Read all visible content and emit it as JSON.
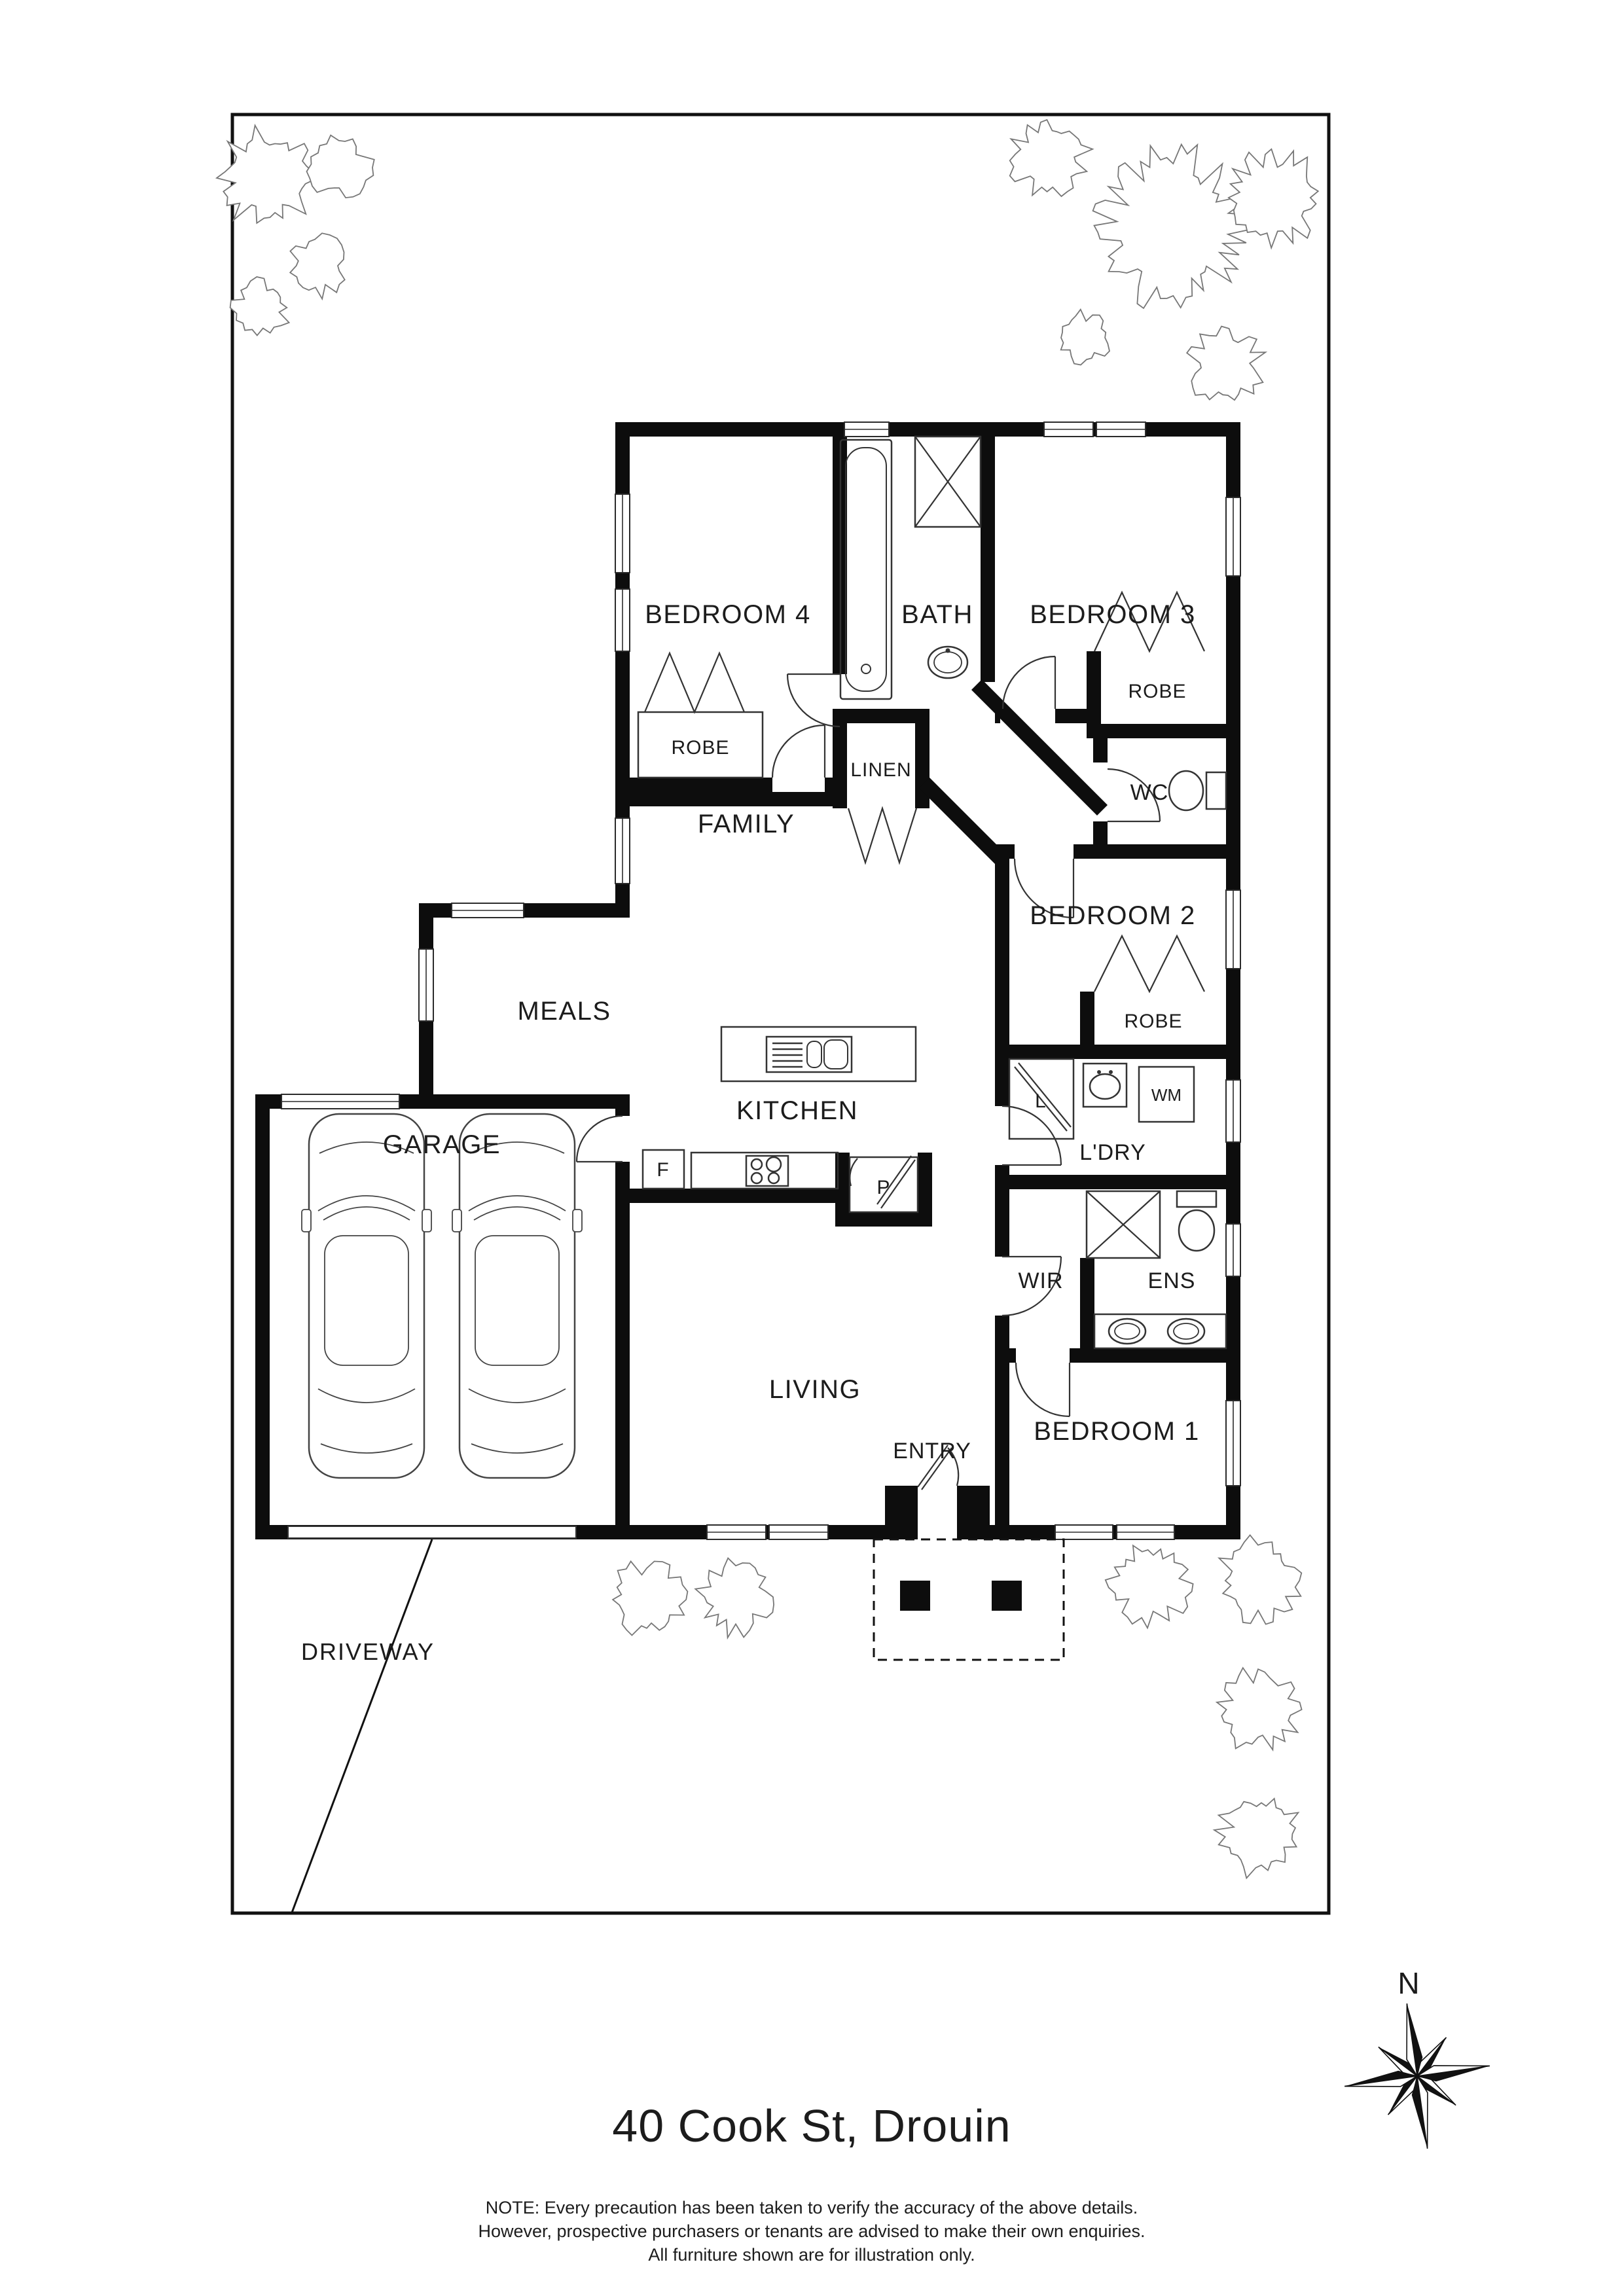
{
  "header": {
    "title": "40 Cook St, Drouin"
  },
  "footer": {
    "note_lines": [
      "NOTE: Every precaution has been taken to verify the accuracy of the above details.",
      "However, prospective purchasers or tenants are advised to make their own enquiries.",
      "All furniture shown are for illustration only."
    ]
  },
  "compass": {
    "north": "N"
  },
  "site": {
    "driveway": "DRIVEWAY"
  },
  "rooms": {
    "bedroom1": "BEDROOM 1",
    "bedroom2": "BEDROOM 2",
    "bedroom3": "BEDROOM 3",
    "bedroom4": "BEDROOM 4",
    "bath": "BATH",
    "wc": "WC",
    "ens": "ENS",
    "wir": "WIR",
    "laundry": "L'DRY",
    "family": "FAMILY",
    "meals": "MEALS",
    "kitchen": "KITCHEN",
    "living": "LIVING",
    "entry": "ENTRY",
    "garage": "GARAGE"
  },
  "labels": {
    "robe": "ROBE",
    "linen": "LINEN",
    "linen_cupboard": "L",
    "washing_machine": "WM",
    "fridge": "F",
    "pantry": "P"
  }
}
